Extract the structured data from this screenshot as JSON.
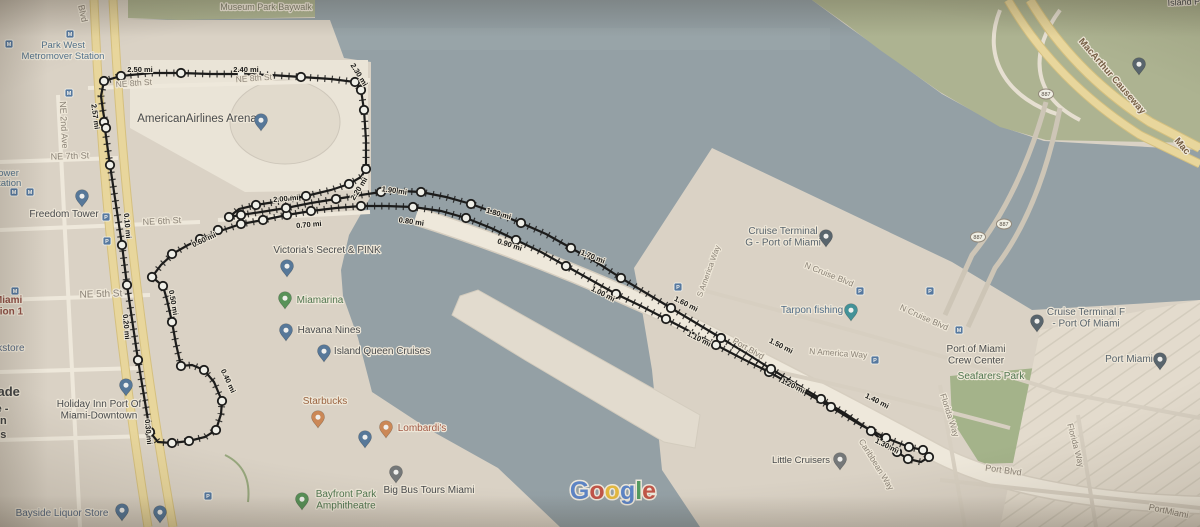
{
  "map": {
    "colors": {
      "water": "#8aa3b5",
      "land": "#dcd7ce",
      "land_light": "#edeae3",
      "park": "#a9b98c",
      "road_yellow": "#f2dd8b",
      "road_white": "#f3efe8",
      "route": "#141414"
    },
    "attribution": {
      "name": "Google",
      "letters": [
        {
          "ch": "G",
          "color": "#4285F4"
        },
        {
          "ch": "o",
          "color": "#EA4335"
        },
        {
          "ch": "o",
          "color": "#FBBC05"
        },
        {
          "ch": "g",
          "color": "#4285F4"
        },
        {
          "ch": "l",
          "color": "#34A853"
        },
        {
          "ch": "e",
          "color": "#EA4335"
        }
      ],
      "x": 613,
      "y": 499,
      "size": 25
    },
    "street_labels": [
      {
        "t": "Museum Park Baywalk",
        "x": 266,
        "y": 10,
        "r": 0,
        "c": "olive",
        "s": 9
      },
      {
        "t": "NE 8th St",
        "x": 134,
        "y": 86,
        "r": -4,
        "c": "street",
        "s": 8.5
      },
      {
        "t": "NE 8th St",
        "x": 254,
        "y": 81,
        "r": -4,
        "c": "street",
        "s": 8.5
      },
      {
        "t": "Blvd",
        "x": 80,
        "y": 14,
        "r": 78,
        "c": "street",
        "s": 9
      },
      {
        "t": "NE 2nd Ave",
        "x": 61,
        "y": 125,
        "r": 87,
        "c": "street",
        "s": 9
      },
      {
        "t": "NE 7th St",
        "x": 70,
        "y": 159,
        "r": -2,
        "c": "street",
        "s": 9
      },
      {
        "t": "NE 6th St",
        "x": 162,
        "y": 224,
        "r": -3,
        "c": "street",
        "s": 9
      },
      {
        "t": "NE 5th St",
        "x": 101,
        "y": 297,
        "r": -2,
        "c": "street",
        "s": 10
      },
      {
        "t": "S America Way",
        "x": 711,
        "y": 272,
        "r": -70,
        "c": "street",
        "s": 8
      },
      {
        "t": "N Cruise Blvd",
        "x": 828,
        "y": 277,
        "r": 22,
        "c": "street",
        "s": 8.5
      },
      {
        "t": "N Cruise Blvd",
        "x": 923,
        "y": 320,
        "r": 24,
        "c": "street",
        "s": 8.5
      },
      {
        "t": "N America Way",
        "x": 838,
        "y": 356,
        "r": 4,
        "c": "street",
        "s": 8.5
      },
      {
        "t": "Port Blvd",
        "x": 747,
        "y": 351,
        "r": 30,
        "c": "street",
        "s": 8.5
      },
      {
        "t": "Port Blvd",
        "x": 1003,
        "y": 473,
        "r": 8,
        "c": "street",
        "s": 9
      },
      {
        "t": "Caribbean Way",
        "x": 874,
        "y": 466,
        "r": 58,
        "c": "street",
        "s": 8.5
      },
      {
        "t": "Florida Way",
        "x": 947,
        "y": 416,
        "r": 72,
        "c": "street",
        "s": 8.5
      },
      {
        "t": "Florida Way",
        "x": 1073,
        "y": 446,
        "r": 75,
        "c": "street",
        "s": 8.5
      },
      {
        "t": "PortMiami",
        "x": 1168,
        "y": 514,
        "r": 12,
        "c": "street",
        "s": 9
      },
      {
        "t": "MacArthur Causeway",
        "x": 1110,
        "y": 78,
        "r": 49,
        "c": "brown",
        "s": 9.5
      },
      {
        "t": "Mac",
        "x": 1180,
        "y": 148,
        "r": 49,
        "c": "brown",
        "s": 9.5
      },
      {
        "t": "Island P",
        "x": 1184,
        "y": 5,
        "r": -3,
        "c": "dark",
        "s": 9
      }
    ],
    "place_labels": [
      {
        "lines": [
          "Park West",
          "Metromover Station"
        ],
        "x": 63,
        "y": 48,
        "c": "blue",
        "s": 9.5
      },
      {
        "lines": [
          "m Tower"
        ],
        "x": 1,
        "y": 176,
        "a": "s",
        "c": "blue",
        "s": 9.5
      },
      {
        "lines": [
          "er Station"
        ],
        "x": 1,
        "y": 186,
        "a": "s",
        "c": "blue",
        "s": 9.5
      },
      {
        "lines": [
          "AmericanAirlines Arena"
        ],
        "x": 197,
        "y": 122,
        "c": "dark",
        "s": 11.5
      },
      {
        "lines": [
          "Freedom Tower"
        ],
        "x": 64,
        "y": 217,
        "c": "dark",
        "s": 10
      },
      {
        "lines": [
          "of Miami",
          "Station 1"
        ],
        "x": 2,
        "y": 303,
        "a": "s",
        "c": "red",
        "s": 10
      },
      {
        "lines": [
          "Bookstore"
        ],
        "x": 2,
        "y": 351,
        "a": "s",
        "c": "bluegray",
        "s": 10
      },
      {
        "lines": [
          "Dade"
        ],
        "x": 4,
        "y": 396,
        "a": "s",
        "c": "bold",
        "s": 13
      },
      {
        "lines": [
          "e -"
        ],
        "x": 2,
        "y": 412,
        "a": "s",
        "c": "bold",
        "s": 11
      },
      {
        "lines": [
          "on"
        ],
        "x": 0,
        "y": 424,
        "a": "s",
        "c": "bold",
        "s": 11
      },
      {
        "lines": [
          "us"
        ],
        "x": 0,
        "y": 438,
        "a": "s",
        "c": "bold",
        "s": 11
      },
      {
        "lines": [
          "Holiday Inn Port Of",
          "Miami-Downtown"
        ],
        "x": 99,
        "y": 407,
        "c": "dark",
        "s": 10
      },
      {
        "lines": [
          "Victoria's Secret & PINK"
        ],
        "x": 327,
        "y": 253,
        "c": "dark",
        "s": 10
      },
      {
        "lines": [
          "Miamarina"
        ],
        "x": 320,
        "y": 303,
        "c": "green",
        "s": 10
      },
      {
        "lines": [
          "Havana Nines"
        ],
        "x": 329,
        "y": 333,
        "c": "dark",
        "s": 10
      },
      {
        "lines": [
          "Island Queen Cruises"
        ],
        "x": 382,
        "y": 354,
        "c": "dark",
        "s": 10
      },
      {
        "lines": [
          "Starbucks"
        ],
        "x": 325,
        "y": 404,
        "c": "orange",
        "s": 10
      },
      {
        "lines": [
          "Lombardi's"
        ],
        "x": 422,
        "y": 431,
        "c": "food",
        "s": 10
      },
      {
        "lines": [
          "Bayfront Park",
          "Amphitheatre"
        ],
        "x": 346,
        "y": 497,
        "c": "green",
        "s": 10
      },
      {
        "lines": [
          "Big Bus Tours Miami"
        ],
        "x": 429,
        "y": 493,
        "c": "dark",
        "s": 10
      },
      {
        "lines": [
          "Bayside Liquor Store"
        ],
        "x": 62,
        "y": 516,
        "c": "bluegray",
        "s": 10
      },
      {
        "lines": [
          "Little Cruisers"
        ],
        "x": 801,
        "y": 463,
        "c": "dark",
        "s": 9.5
      },
      {
        "lines": [
          "Cruise Terminal",
          "G - Port of Miami"
        ],
        "x": 783,
        "y": 234,
        "c": "slate",
        "s": 10
      },
      {
        "lines": [
          "Tarpon fishing"
        ],
        "x": 812,
        "y": 313,
        "c": "blue2",
        "s": 10
      },
      {
        "lines": [
          "Cruise Terminal F",
          "- Port Of Miami"
        ],
        "x": 1086,
        "y": 315,
        "c": "slate",
        "s": 10
      },
      {
        "lines": [
          "Port of Miami",
          "Crew Center"
        ],
        "x": 976,
        "y": 352,
        "c": "dark",
        "s": 10
      },
      {
        "lines": [
          "Seafarers Park"
        ],
        "x": 991,
        "y": 379,
        "c": "green",
        "s": 10
      },
      {
        "lines": [
          "Port Miami"
        ],
        "x": 1129,
        "y": 362,
        "c": "slate",
        "s": 10
      }
    ],
    "mile_markers": [
      {
        "t": "0.10 mi",
        "x": 125,
        "y": 226,
        "r": 85
      },
      {
        "t": "0.20 mi",
        "x": 124,
        "y": 327,
        "r": 85
      },
      {
        "t": "0.30 mi",
        "x": 146,
        "y": 432,
        "r": 85
      },
      {
        "t": "0.40 mi",
        "x": 226,
        "y": 382,
        "r": 65
      },
      {
        "t": "0.50 mi",
        "x": 171,
        "y": 303,
        "r": 80
      },
      {
        "t": "0.60 mi",
        "x": 205,
        "y": 242,
        "r": -25
      },
      {
        "t": "0.70 mi",
        "x": 309,
        "y": 227,
        "r": -5
      },
      {
        "t": "0.80 mi",
        "x": 411,
        "y": 224,
        "r": 8
      },
      {
        "t": "0.90 mi",
        "x": 509,
        "y": 247,
        "r": 18
      },
      {
        "t": "1.00 mi",
        "x": 602,
        "y": 296,
        "r": 27
      },
      {
        "t": "1.10 mi",
        "x": 698,
        "y": 341,
        "r": 27
      },
      {
        "t": "1.20 mi",
        "x": 792,
        "y": 388,
        "r": 27
      },
      {
        "t": "1.30 mi",
        "x": 886,
        "y": 448,
        "r": 27
      },
      {
        "t": "1.40 mi",
        "x": 876,
        "y": 403,
        "r": 27
      },
      {
        "t": "1.50 mi",
        "x": 780,
        "y": 348,
        "r": 27
      },
      {
        "t": "1.60 mi",
        "x": 685,
        "y": 306,
        "r": 27
      },
      {
        "t": "1.70 mi",
        "x": 592,
        "y": 259,
        "r": 22
      },
      {
        "t": "1.80 mi",
        "x": 498,
        "y": 216,
        "r": 16
      },
      {
        "t": "1.90 mi",
        "x": 394,
        "y": 193,
        "r": 8
      },
      {
        "t": "2.00 mi",
        "x": 286,
        "y": 201,
        "r": -5
      },
      {
        "t": "2.20 mi",
        "x": 361,
        "y": 190,
        "r": -58
      },
      {
        "t": "2.30 mi",
        "x": 357,
        "y": 76,
        "r": 58
      },
      {
        "t": "2.40 mi",
        "x": 246,
        "y": 72,
        "r": 0
      },
      {
        "t": "2.50 mi",
        "x": 140,
        "y": 72,
        "r": 0
      },
      {
        "t": "2.57 mi",
        "x": 93,
        "y": 117,
        "r": 82
      }
    ],
    "route": {
      "outbound": "M104,122 L110,165 122,245 127,285 138,360 150,432 158,442 172,443 189,441 205,437 216,430 221,414 222,401 214,382 204,370 192,365 181,366 176,344 172,322 167,300 163,286 152,277 161,265 174,253 188,245 203,238 220,231 241,224 263,220 287,215 311,211 336,208 361,206 386,206 413,207 441,211 466,218 491,228 516,240 541,252 566,266 591,280 616,294 641,306 666,319 691,332 716,345 741,358 769,372 801,390 831,407 859,424 886,438 909,447 923,450 929,457 921,462 908,459 897,452",
      "return": "M897,452 L871,431 846,414 821,399 796,384 771,369 746,353 721,338 696,323 671,308 646,293 621,278 596,262 571,248 546,234 521,223 496,213 471,204 446,197 421,192 401,191 381,192 361,195 336,199 311,203 286,208 261,212 241,215 229,217 239,209 256,205 281,201 306,196 331,190 349,184 361,177 366,169 366,140 364,110 361,90 355,82 331,79 301,77 271,75 241,74 211,74 181,73 151,73 121,76 104,81 101,96 103,111 106,128",
      "dots": [
        [
          104,
          122
        ],
        [
          110,
          165
        ],
        [
          122,
          245
        ],
        [
          127,
          285
        ],
        [
          138,
          360
        ],
        [
          150,
          432
        ],
        [
          172,
          443
        ],
        [
          189,
          441
        ],
        [
          216,
          430
        ],
        [
          222,
          401
        ],
        [
          204,
          370
        ],
        [
          181,
          366
        ],
        [
          172,
          322
        ],
        [
          163,
          286
        ],
        [
          152,
          277
        ],
        [
          172,
          254
        ],
        [
          200,
          239
        ],
        [
          218,
          230
        ],
        [
          241,
          224
        ],
        [
          263,
          220
        ],
        [
          287,
          215
        ],
        [
          311,
          211
        ],
        [
          361,
          206
        ],
        [
          413,
          207
        ],
        [
          466,
          218
        ],
        [
          516,
          240
        ],
        [
          566,
          266
        ],
        [
          616,
          294
        ],
        [
          666,
          319
        ],
        [
          716,
          345
        ],
        [
          769,
          372
        ],
        [
          831,
          407
        ],
        [
          886,
          438
        ],
        [
          909,
          447
        ],
        [
          923,
          450
        ],
        [
          929,
          457
        ],
        [
          908,
          459
        ],
        [
          897,
          452
        ],
        [
          871,
          431
        ],
        [
          821,
          399
        ],
        [
          771,
          369
        ],
        [
          721,
          338
        ],
        [
          671,
          308
        ],
        [
          621,
          278
        ],
        [
          571,
          248
        ],
        [
          521,
          223
        ],
        [
          471,
          204
        ],
        [
          421,
          192
        ],
        [
          381,
          192
        ],
        [
          336,
          199
        ],
        [
          286,
          208
        ],
        [
          241,
          215
        ],
        [
          229,
          217
        ],
        [
          256,
          205
        ],
        [
          306,
          196
        ],
        [
          349,
          184
        ],
        [
          366,
          169
        ],
        [
          364,
          110
        ],
        [
          361,
          90
        ],
        [
          355,
          82
        ],
        [
          301,
          77
        ],
        [
          241,
          74
        ],
        [
          181,
          73
        ],
        [
          121,
          76
        ],
        [
          104,
          81
        ],
        [
          106,
          128
        ]
      ]
    },
    "pins": [
      {
        "x": 261,
        "y": 131,
        "c": "#4179b5",
        "k": "americanairlines-arena-pin"
      },
      {
        "x": 82,
        "y": 207,
        "c": "#4179b5",
        "k": "freedom-tower-museum-pin"
      },
      {
        "x": 287,
        "y": 277,
        "c": "#4179b5",
        "k": "victorias-secret-pin"
      },
      {
        "x": 285,
        "y": 309,
        "c": "#3f9e49",
        "k": "miamarina-pin"
      },
      {
        "x": 286,
        "y": 341,
        "c": "#4179b5",
        "k": "havana-nines-pin"
      },
      {
        "x": 324,
        "y": 362,
        "c": "#4179b5",
        "k": "island-queen-cruises-pin"
      },
      {
        "x": 126,
        "y": 396,
        "c": "#4179b5",
        "k": "holiday-inn-pin"
      },
      {
        "x": 318,
        "y": 428,
        "c": "#e8823c",
        "k": "starbucks-pin"
      },
      {
        "x": 386,
        "y": 438,
        "c": "#e8823c",
        "k": "lombardis-pin"
      },
      {
        "x": 365,
        "y": 448,
        "c": "#4179b5",
        "k": "poi-pin"
      },
      {
        "x": 302,
        "y": 510,
        "c": "#3f9e49",
        "k": "bayfront-park-pin"
      },
      {
        "x": 396,
        "y": 483,
        "c": "#6e7780",
        "k": "big-bus-tours-pin"
      },
      {
        "x": 122,
        "y": 521,
        "c": "#4179b5",
        "k": "bayside-liquor-pin"
      },
      {
        "x": 160,
        "y": 523,
        "c": "#4179b5",
        "k": "bayside-liquor-pin-2"
      },
      {
        "x": 840,
        "y": 470,
        "c": "#6e7780",
        "k": "little-cruisers-pin"
      },
      {
        "x": 826,
        "y": 247,
        "c": "#4e6377",
        "k": "cruise-terminal-g-pin"
      },
      {
        "x": 851,
        "y": 321,
        "c": "#1a9eae",
        "k": "tarpon-fishing-pin"
      },
      {
        "x": 1037,
        "y": 332,
        "c": "#4e6377",
        "k": "cruise-terminal-f-pin"
      },
      {
        "x": 1160,
        "y": 370,
        "c": "#4e6377",
        "k": "port-miami-pin"
      },
      {
        "x": 1139,
        "y": 75,
        "c": "#4e6377",
        "k": "island-poi-pin"
      }
    ],
    "square_icons": [
      {
        "x": 9,
        "y": 44,
        "g": "M",
        "k": "metromover-station-icon"
      },
      {
        "x": 70,
        "y": 34,
        "g": "M",
        "k": "metromover-station-icon"
      },
      {
        "x": 69,
        "y": 93,
        "g": "M",
        "k": "metromover-station-icon"
      },
      {
        "x": 14,
        "y": 192,
        "g": "M",
        "k": "metromover-station-icon"
      },
      {
        "x": 30,
        "y": 192,
        "g": "M",
        "k": "metromover-station-icon"
      },
      {
        "x": 15,
        "y": 291,
        "g": "M",
        "k": "metromover-station-icon"
      },
      {
        "x": 106,
        "y": 217,
        "g": "P",
        "k": "parking-icon"
      },
      {
        "x": 107,
        "y": 241,
        "g": "P",
        "k": "parking-icon"
      },
      {
        "x": 208,
        "y": 496,
        "g": "P",
        "k": "parking-icon"
      },
      {
        "x": 678,
        "y": 287,
        "g": "P",
        "k": "parking-icon"
      },
      {
        "x": 860,
        "y": 291,
        "g": "P",
        "k": "parking-icon"
      },
      {
        "x": 930,
        "y": 291,
        "g": "P",
        "k": "parking-icon"
      },
      {
        "x": 875,
        "y": 360,
        "g": "P",
        "k": "parking-icon"
      },
      {
        "x": 959,
        "y": 330,
        "g": "M",
        "k": "crew-center-transit-icon"
      }
    ],
    "route_shields": [
      {
        "t": "887",
        "x": 1046,
        "y": 94
      },
      {
        "t": "887",
        "x": 1004,
        "y": 224
      },
      {
        "t": "887",
        "x": 978,
        "y": 237
      }
    ]
  }
}
